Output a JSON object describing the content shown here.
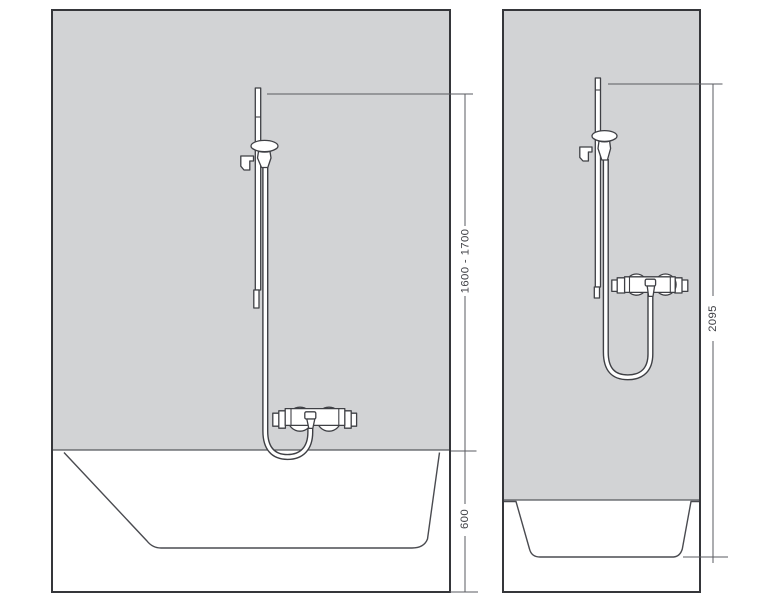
{
  "diagram": {
    "left_panel": {
      "scene": "bathtub-installation",
      "fixtures": [
        "slide-bar",
        "hand-shower",
        "shower-hose",
        "thermostat-mixer",
        "bathtub"
      ]
    },
    "right_panel": {
      "scene": "shower-tray-installation",
      "fixtures": [
        "slide-bar",
        "hand-shower",
        "shower-hose",
        "thermostat-mixer",
        "shower-tray"
      ]
    }
  },
  "dimensions": {
    "left_bar_height": "1600 - 1700",
    "left_tub_height": "600",
    "right_total_height": "2095"
  },
  "colors": {
    "background": "#ffffff",
    "wall_fill": "#d2d3d5",
    "fixture_outline": "#3f4045",
    "panel_border": "#35363a",
    "dimension_line": "#5a5b60",
    "dimension_text": "#414247"
  }
}
